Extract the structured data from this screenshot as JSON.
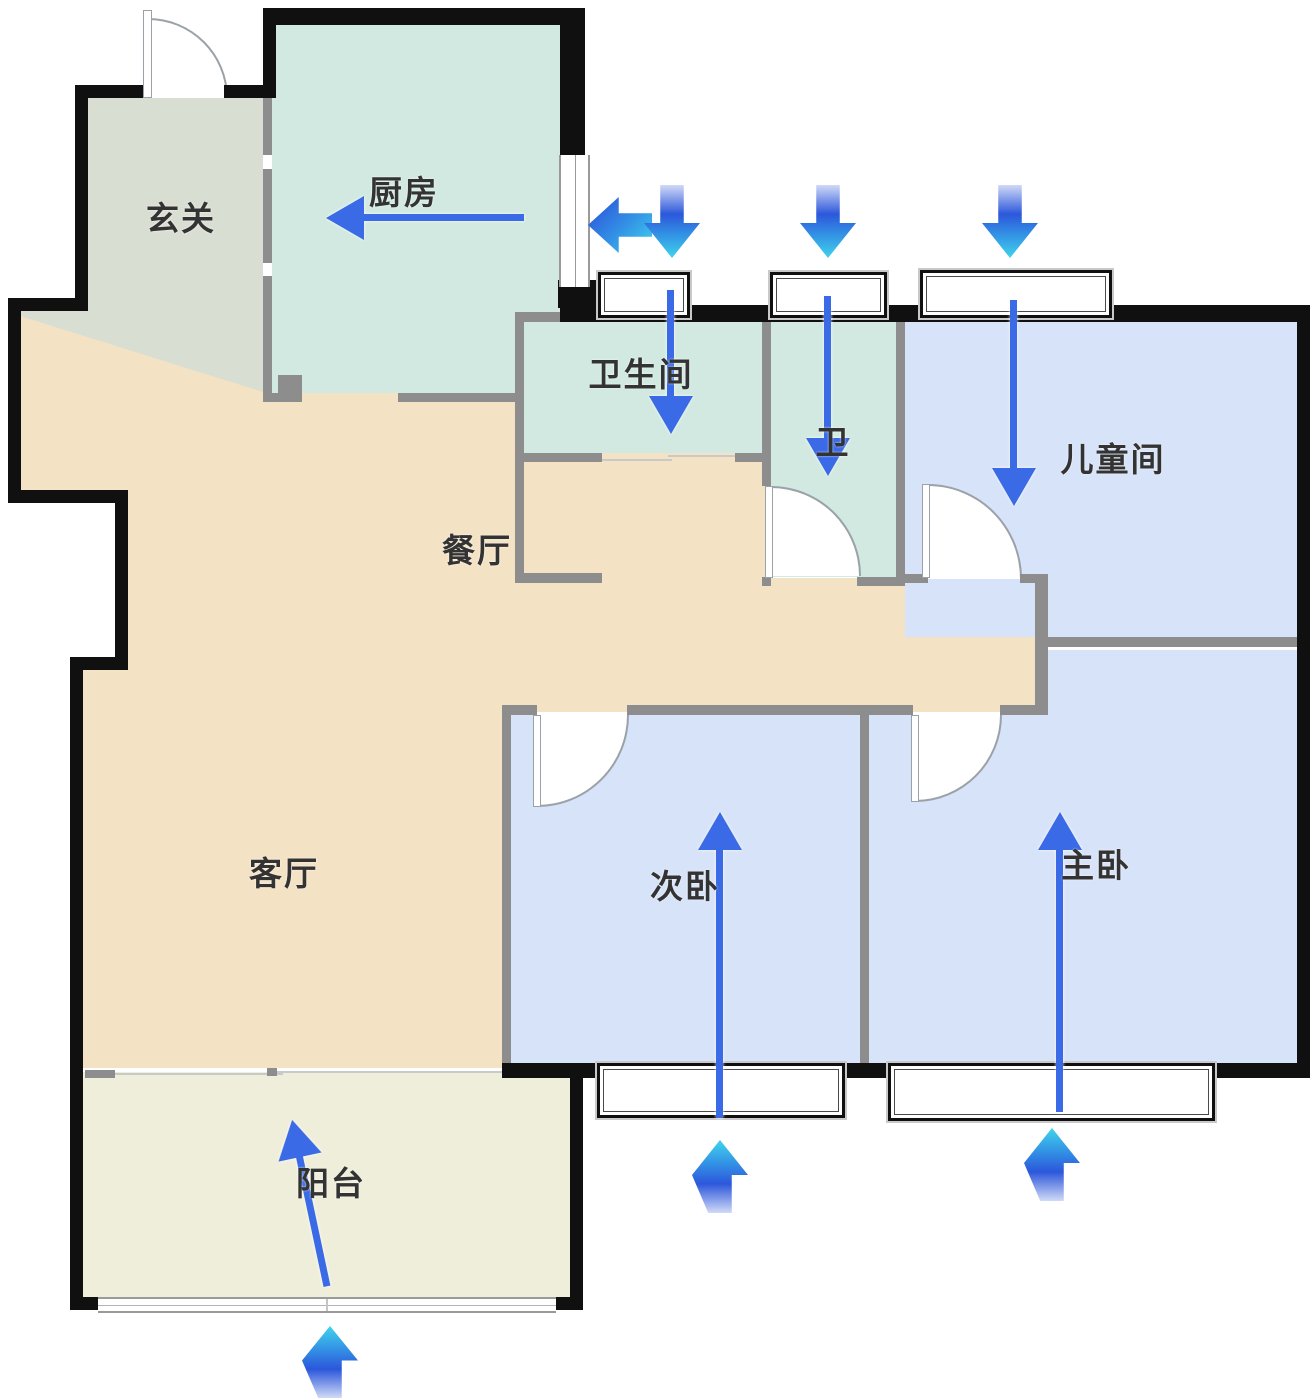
{
  "meta": {
    "kind": "apartment-floor-plan",
    "language": "zh-CN"
  },
  "rooms": [
    {
      "id": "entry",
      "label": "玄关"
    },
    {
      "id": "kitchen",
      "label": "厨房"
    },
    {
      "id": "bathroom",
      "label": "卫生间"
    },
    {
      "id": "toilet",
      "label": "卫"
    },
    {
      "id": "kids-room",
      "label": "儿童间"
    },
    {
      "id": "dining-room",
      "label": "餐厅"
    },
    {
      "id": "living-room",
      "label": "客厅"
    },
    {
      "id": "second-bedroom",
      "label": "次卧"
    },
    {
      "id": "master-bedroom",
      "label": "主卧"
    },
    {
      "id": "balcony",
      "label": "阳台"
    }
  ],
  "airflow": {
    "bold_arrows": [
      {
        "icon": "arrow-left-icon",
        "at": "kitchen-east-window-exterior",
        "direction": "left"
      },
      {
        "icon": "arrow-down-icon",
        "at": "bathroom-window-exterior",
        "direction": "down"
      },
      {
        "icon": "arrow-down-icon",
        "at": "toilet-window-exterior",
        "direction": "down"
      },
      {
        "icon": "arrow-down-icon",
        "at": "kids-room-window-exterior",
        "direction": "down"
      },
      {
        "icon": "arrow-up-icon",
        "at": "balcony-exterior",
        "direction": "up"
      },
      {
        "icon": "arrow-up-icon",
        "at": "second-bedroom-window-exterior",
        "direction": "up"
      },
      {
        "icon": "arrow-up-icon",
        "at": "master-bedroom-window-exterior",
        "direction": "up"
      }
    ],
    "thin_arrows": [
      {
        "icon": "flow-arrow-icon",
        "room": "kitchen",
        "direction": "left"
      },
      {
        "icon": "flow-arrow-icon",
        "room": "bathroom",
        "direction": "down"
      },
      {
        "icon": "flow-arrow-icon",
        "room": "toilet",
        "direction": "down"
      },
      {
        "icon": "flow-arrow-icon",
        "room": "kids-room",
        "direction": "down"
      },
      {
        "icon": "flow-arrow-icon",
        "room": "second-bedroom",
        "direction": "up"
      },
      {
        "icon": "flow-arrow-icon",
        "room": "master-bedroom",
        "direction": "up"
      },
      {
        "icon": "flow-arrow-icon",
        "room": "balcony",
        "direction": "up-tilted"
      }
    ]
  },
  "colors": {
    "sage": "#d9ded2",
    "mint": "#d1e9e1",
    "beige": "#f4e2c5",
    "blue": "#d7e3f8",
    "balcony-floor": "#efeeda",
    "wall-black": "#101010",
    "wall-gray": "#8d8d8d",
    "wall-light": "#c9c9c9",
    "door-line": "#9aa2a8",
    "arrow-blue": "#3a6ae6",
    "grad-fade": "rgba(43,85,217,0.22)",
    "grad-deep": "#2c57db",
    "grad-mid": "#3392e5",
    "grad-cyan": "#40d4ec",
    "label": "#333333"
  }
}
